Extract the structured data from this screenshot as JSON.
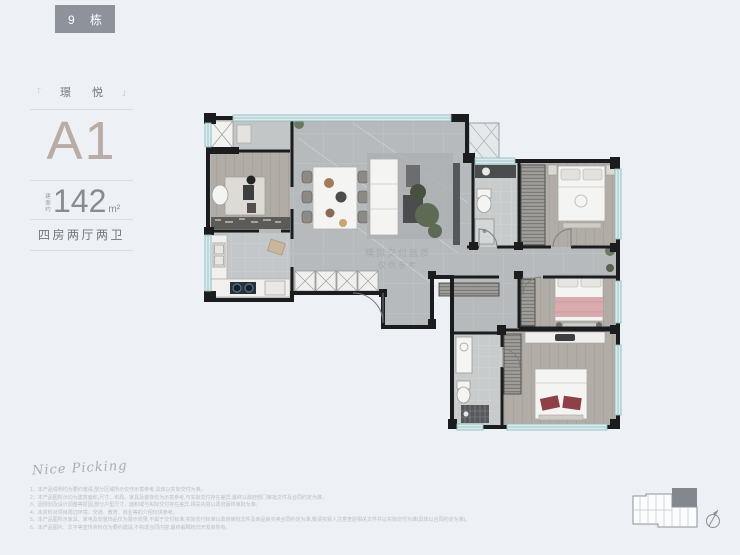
{
  "badge": {
    "label": "9 栋"
  },
  "unit_info": {
    "project_name": "璟 悦",
    "deco_left": "「",
    "deco_right": "」",
    "unit_label": "A1",
    "area_prefix": "建面约",
    "area_value": "142",
    "area_unit": "m²",
    "layout_label": "四房两厅两卫"
  },
  "signature": "Nice Picking",
  "floor_plan": {
    "watermark_line1": "模拟交付画质",
    "watermark_line2": "仅供参考"
  },
  "disclaimers": [
    "1、本产品说明均为要约邀请,部分区域所示仅作示意参考,具体以实际交付为准。",
    "2、本产品图所示均为建筑面积,尺寸、布局、家具及装饰仅为示意参考,与实际交付存在差异,最终以政府部门审批文件及合同约定为准。",
    "3、因规划及设计调整等原因,部分户型尺寸、面积或与实际交付存在差异,相关内容以政府最终审批为准。",
    "4、本资料对项目周边环境、交通、教育、商业等的介绍仅供参考。",
    "5、本产品图所示家具、家电及软装饰品仅为展示效果,不属于交付标准;实际交付标准以政府审批文件及商品房买卖合同约定为准,敬请买受人注意查验相关文件并以实际交付为准(具体以合同约定为准)。",
    "6、本产品图片、文字等宣传资料仅为要约邀请,不构成合同内容,最终解释权归开发商所有。"
  ],
  "colors": {
    "background": "#edf0f4",
    "badge_bg": "#8e939b",
    "accent_taupe": "#b8aca5",
    "wall": "#1b1c1e",
    "window_teal": "#8fbec2",
    "bed_pink": "#d9abae",
    "accent_red": "#8f4046"
  }
}
